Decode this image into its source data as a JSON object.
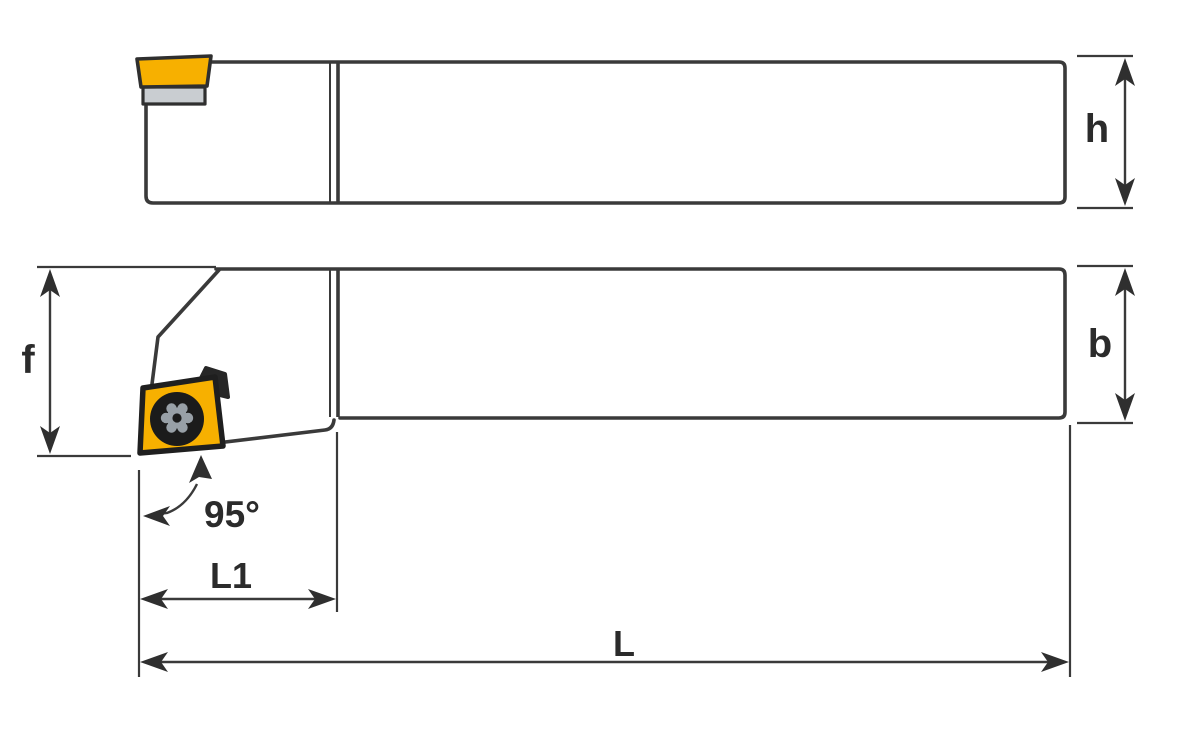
{
  "diagram": {
    "labels": {
      "shank_height": "h",
      "shank_width": "b",
      "head_overhang": "f",
      "head_length": "L1",
      "overall_length": "L",
      "entering_angle": "95°"
    },
    "colors": {
      "line": "#3a3a3a",
      "text": "#2b2b2b",
      "insert_yellow": "#f7b000",
      "shim_gray": "#c9cdd1",
      "screw_black": "#1b1b1b",
      "torx_gray": "#98a0a7",
      "background": "#ffffff"
    }
  }
}
